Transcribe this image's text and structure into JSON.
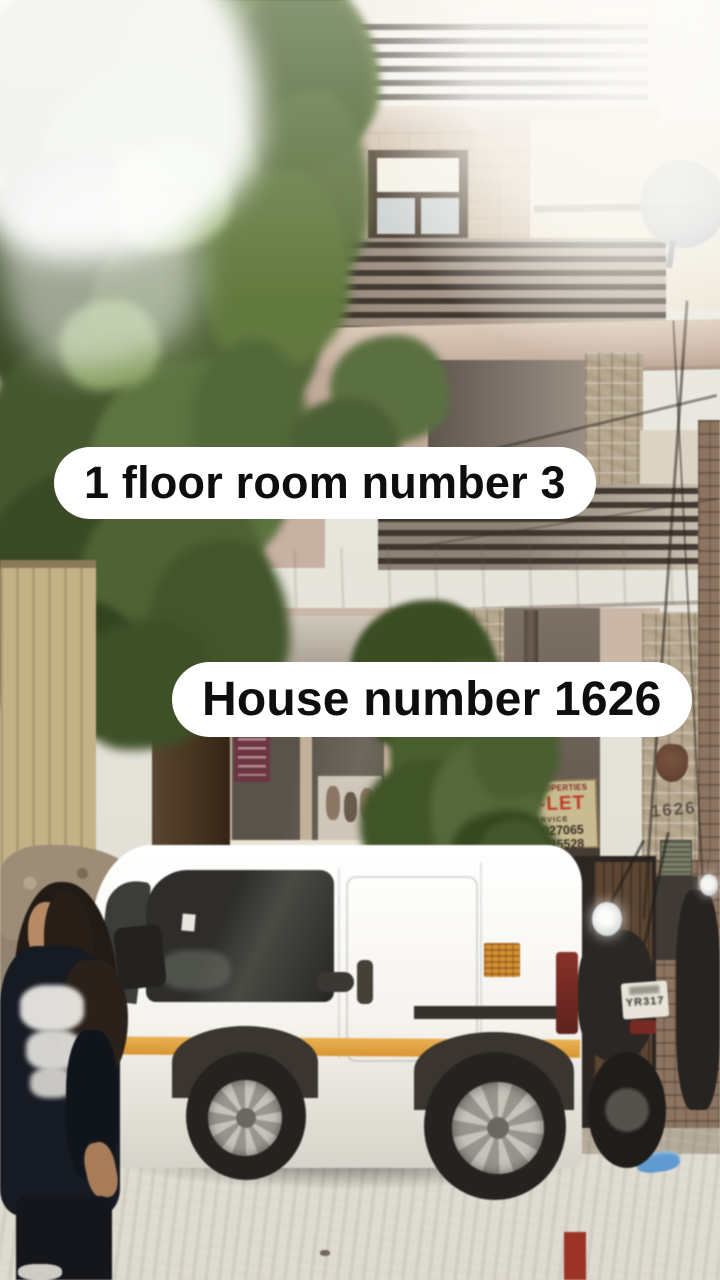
{
  "overlays": {
    "caption_top": "1 floor room number 3",
    "caption_bottom": "House number 1626"
  },
  "building": {
    "pillar_house_number": "1626",
    "tolet_sign": {
      "agency": "ARYA PROPERTIES",
      "title": "TO-LET",
      "subtitle": "SERVICE",
      "phone1": "8447027065",
      "phone2": "8851035528"
    }
  },
  "vehicles": {
    "bike_plate": "YR317"
  },
  "colors": {
    "overlay_bg": "#ffffff",
    "overlay_text": "#0e0e0e",
    "tolet_title_red": "#c23b28",
    "van_stripe_orange": "#e2a13c",
    "foliage_green": "#55683a",
    "wall_pink": "#cdb3a4"
  }
}
